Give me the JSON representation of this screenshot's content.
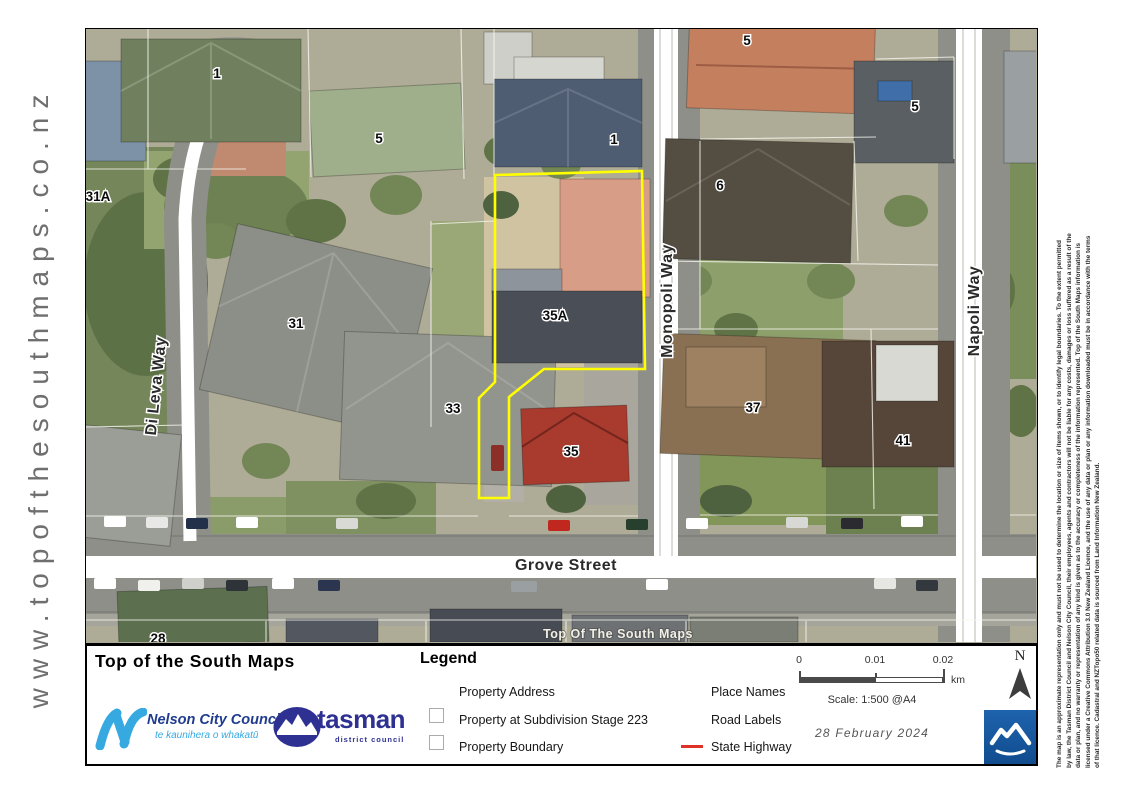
{
  "site_url": "www.topofthesouthmaps.co.nz",
  "map": {
    "watermark": "Top Of The South Maps",
    "highlight_property": "35A",
    "highlight_color": "#ffff00",
    "street_labels": [
      "Grove Street",
      "Monopoli Way",
      "Napoli Way",
      "Di Leva Way"
    ],
    "house_labels": [
      "1",
      "5",
      "31A",
      "1",
      "5",
      "5",
      "6",
      "31",
      "33",
      "35A",
      "35",
      "37",
      "41",
      "28"
    ]
  },
  "legend": {
    "panel_title": "Top of the South Maps",
    "heading": "Legend",
    "column1": [
      {
        "symbol": "none",
        "label": "Property Address"
      },
      {
        "symbol": "square-outline",
        "label": "Property at Subdivision Stage 223"
      },
      {
        "symbol": "square-outline",
        "label": "Property Boundary"
      }
    ],
    "column2": [
      {
        "symbol": "none",
        "label": "Place Names"
      },
      {
        "symbol": "none",
        "label": "Road Labels"
      },
      {
        "symbol": "red-line",
        "label": "State Highway"
      }
    ],
    "state_highway_color": "#e03127",
    "scale_bar": {
      "tick0": "0",
      "tick1": "0.01",
      "tick2": "0.02",
      "unit": "km",
      "scale_text": "Scale: 1:500 @A4"
    },
    "date": "28 February 2024",
    "north_label": "N"
  },
  "logos": {
    "nelson_name": "Nelson City Council",
    "nelson_subtitle": "te kaunihera o whakatū",
    "nelson_accent": "#36a9e1",
    "tasman_name": "tasman",
    "tasman_subtitle": "district council",
    "tasman_color": "#2e3192",
    "tile_color": "#1b5ca8"
  },
  "disclaimer": {
    "lines": [
      "The map is an approximate representation only and must not be used to determine the location or size of items shown, or to identify legal boundaries. To the extent permitted",
      "by law, the Tasman District Council and Nelson City Council, their employees, agents and contractors will not be liable for any costs, damages or loss suffered as a result of the",
      "data or plan, and no warranty or representation of any kind is given as to the accuracy or completeness of the information represented. Top of the South Maps information is",
      "licensed under a Creative Commons Attribution 3.0 New Zealand Licence, and the use of any data or plan or any information downloaded must be in accordance with the terms",
      "of that licence. Cadastral and NZTopo50 related data is sourced from Land Information New Zealand."
    ]
  }
}
